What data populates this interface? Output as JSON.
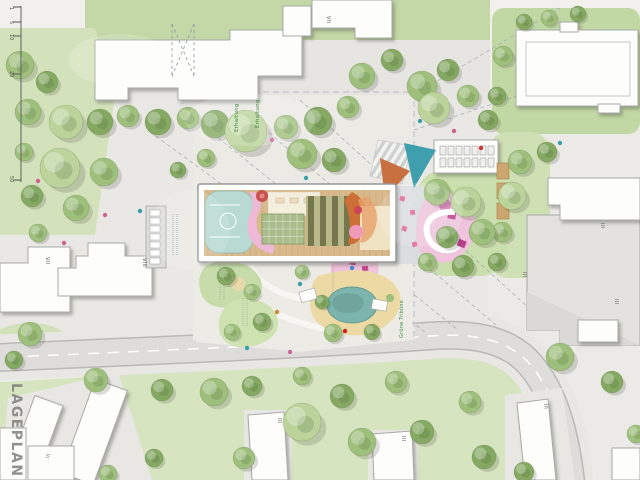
{
  "title": {
    "text": "LAGEPLAN"
  },
  "scale_bar": {
    "description": "vertical scale bar, meters",
    "ticks": [
      "1",
      "5",
      "10",
      "20",
      "50"
    ]
  },
  "building_storey_labels": [
    {
      "building": "top-center-building",
      "text": "VII"
    },
    {
      "building": "left-small-building",
      "text": "VII"
    },
    {
      "building": "left-mid-building",
      "text": "VIII"
    },
    {
      "building": "right-white-building",
      "text": "III"
    },
    {
      "building": "right-gray-building-upper",
      "text": "III"
    },
    {
      "building": "right-gray-building-lower",
      "text": "III"
    },
    {
      "building": "bottom-right-slab",
      "text": "III"
    },
    {
      "building": "bottom-center-slab-1",
      "text": "III"
    },
    {
      "building": "bottom-center-slab-2",
      "text": "III"
    },
    {
      "building": "bottom-left-corner-building",
      "text": "III"
    }
  ],
  "annotations": {
    "tree_preservation_1": {
      "text": "Erhaltung"
    },
    "tree_preservation_2": {
      "text": "Erhaltung"
    },
    "green_tribune": {
      "text": "Grüne Tribüne"
    }
  },
  "legend_colors": {
    "lawn": "#d6e4bf",
    "tree_light": "#bcd49b",
    "tree_mid": "#9fc07c",
    "tree_dark": "#85a963",
    "plaza": "#e9e8e4",
    "road": "#dedddb",
    "building_fill": "#fdfdfc",
    "existing_building": "#e3e2df",
    "wood_deck": "#d9ba8c",
    "ball_court": "#b9d9d3",
    "play_pink": "#efc4dc",
    "pond_teal": "#7cb5ad",
    "sand": "#ecd9a4",
    "sail_teal": "#3f9fae",
    "sail_orange": "#c97040",
    "accent_magenta": "#b9408a",
    "slide_orange": "#cf6f38"
  }
}
